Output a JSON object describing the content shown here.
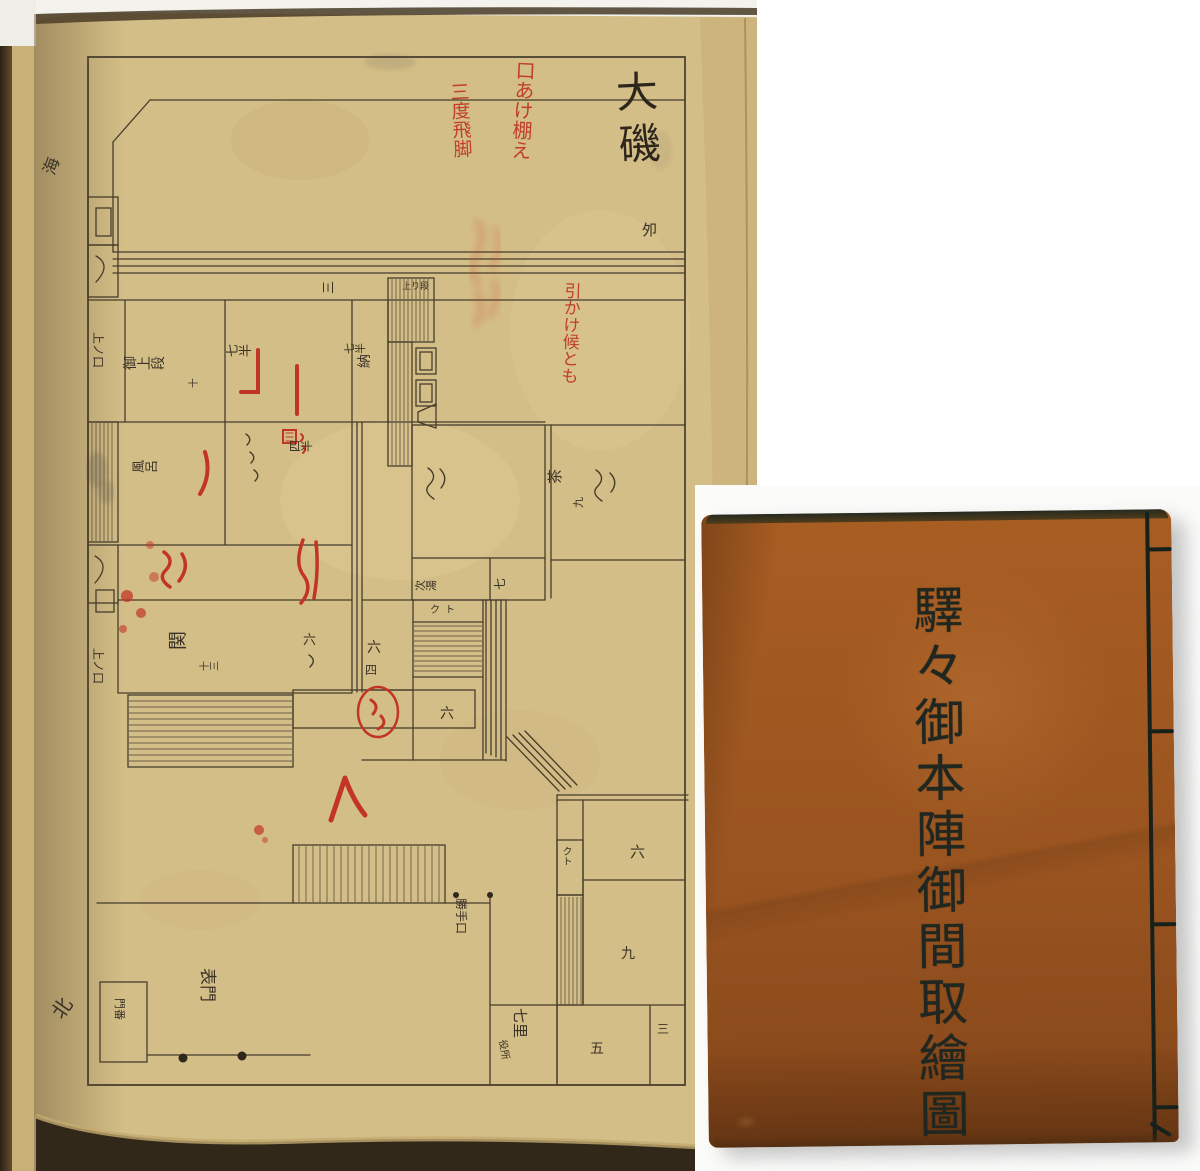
{
  "plan_page": {
    "place_name": "大磯",
    "seal_mark": "夘",
    "sea_mark": "海",
    "north_mark": "北",
    "red_notes": {
      "a": "口あけ棚え",
      "b": "三度飛脚",
      "c": "引かけ候とも"
    },
    "rooms": {
      "ue_no_kuchi": "上ノ口",
      "kamidan": "御上段",
      "kamidan_mats": "十",
      "shichihan_a": "七半",
      "shichihan_b": "七半",
      "osame": "納",
      "agaridan": "上り段",
      "veranda_mats": "三",
      "furo": "風呂",
      "yonhan": "四半",
      "cha": "茶",
      "cha_mats": "九",
      "tsugi_yu": "次湯",
      "shichi": "七",
      "kuto_a": "クト",
      "kuto_b": "クト",
      "roku_a": "六",
      "roku_b": "六",
      "roku_c": "六",
      "roku_d": "六",
      "yon": "四",
      "genkan": "関",
      "genkan_mats": "十三",
      "kyu": "九",
      "go": "五",
      "san": "三",
      "shichiri": "七里",
      "yakusho": "役所",
      "katte_guchi": "勝手口",
      "omote_mon": "表門",
      "monban": "門番"
    }
  },
  "cover": {
    "title": "驛々御本陣御間取繪圖"
  }
}
